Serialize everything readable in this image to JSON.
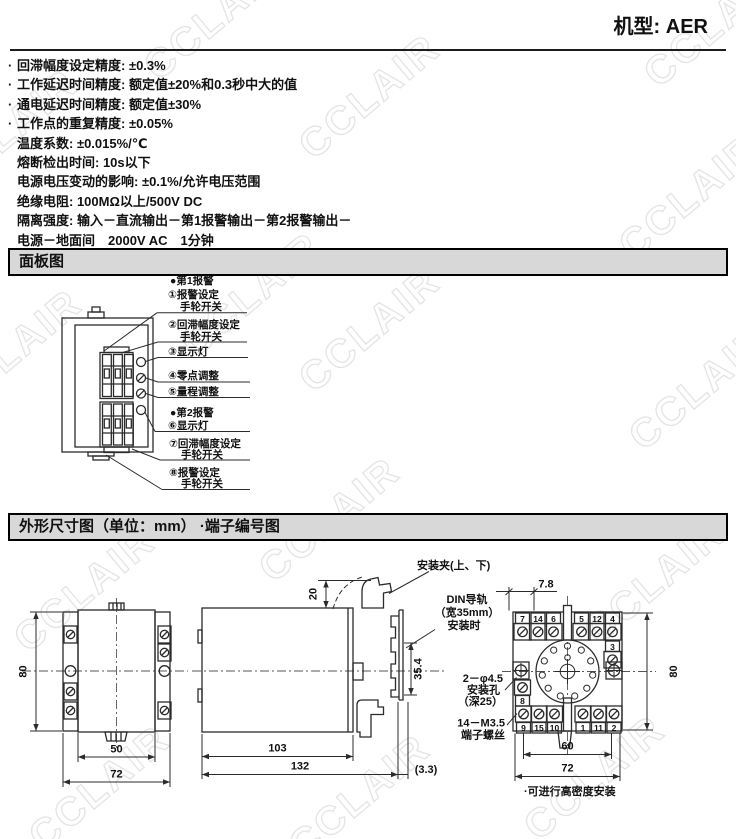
{
  "header": {
    "model": "机型: AER"
  },
  "specs": {
    "items": [
      {
        "marker": "·",
        "text": "回滞幅度设定精度: ±0.3%"
      },
      {
        "marker": "·",
        "text": "工作延迟时间精度: 额定值±20%和0.3秒中大的值"
      },
      {
        "marker": "·",
        "text": "通电延迟时间精度: 额定值±30%"
      },
      {
        "marker": "·",
        "text": "工作点的重复精度: ±0.05%"
      },
      {
        "marker": "",
        "text": "温度系数: ±0.015%/℃"
      },
      {
        "marker": "",
        "text": "熔断检出时间: 10s以下"
      },
      {
        "marker": "",
        "text": "电源电压变动的影响: ±0.1%/允许电压范围"
      },
      {
        "marker": "",
        "text": "绝缘电阻: 100MΩ以上/500V DC"
      },
      {
        "marker": "",
        "text": "隔离强度: 输入－直流输出－第1报警输出－第2报警输出－"
      },
      {
        "marker": "",
        "text": "电源－地面间　2000V AC　1分钟"
      }
    ]
  },
  "sections": {
    "panel_title": "面板图",
    "dim_title": "外形尺寸图（单位：mm） ·端子编号图"
  },
  "panel": {
    "labels": {
      "alarm1": "●第1报警",
      "l1a": "①报警设定",
      "l1b": "手轮开关",
      "l2a": "②回滞幅度设定",
      "l2b": "手轮开关",
      "l3": "③显示灯",
      "l4": "④零点调整",
      "l5": "⑤量程调整",
      "alarm2": "●第2报警",
      "l6": "⑥显示灯",
      "l7a": "⑦回滞幅度设定",
      "l7b": "手轮开关",
      "l8a": "⑧报警设定",
      "l8b": "手轮开关"
    }
  },
  "dims": {
    "front": {
      "height": "80",
      "width_inner": "50",
      "width_outer": "72"
    },
    "side": {
      "clip": "安装夹(上、下)",
      "clip_h": "20",
      "din1": "DIN导轨",
      "din2": "（宽35mm）",
      "din3": "安装时",
      "rail": "35.4",
      "d1": "103",
      "d2": "132",
      "gap": "(3.3)"
    },
    "terminal": {
      "pitch": "7.8",
      "height": "80",
      "w_inner": "60",
      "w_outer": "72",
      "top": [
        "7",
        "14",
        "6",
        "5",
        "12",
        "4"
      ],
      "n3": "3",
      "n8": "8",
      "bottom": [
        "9",
        "15",
        "10",
        "1",
        "11",
        "2"
      ],
      "hole1": "2－φ4.5",
      "hole2": "安装孔",
      "hole3": "（深25）",
      "screw1": "14－M3.5",
      "screw2": "端子螺丝",
      "note": "·可进行高密度安装"
    }
  },
  "watermark": {
    "text": "CCLAIR"
  }
}
